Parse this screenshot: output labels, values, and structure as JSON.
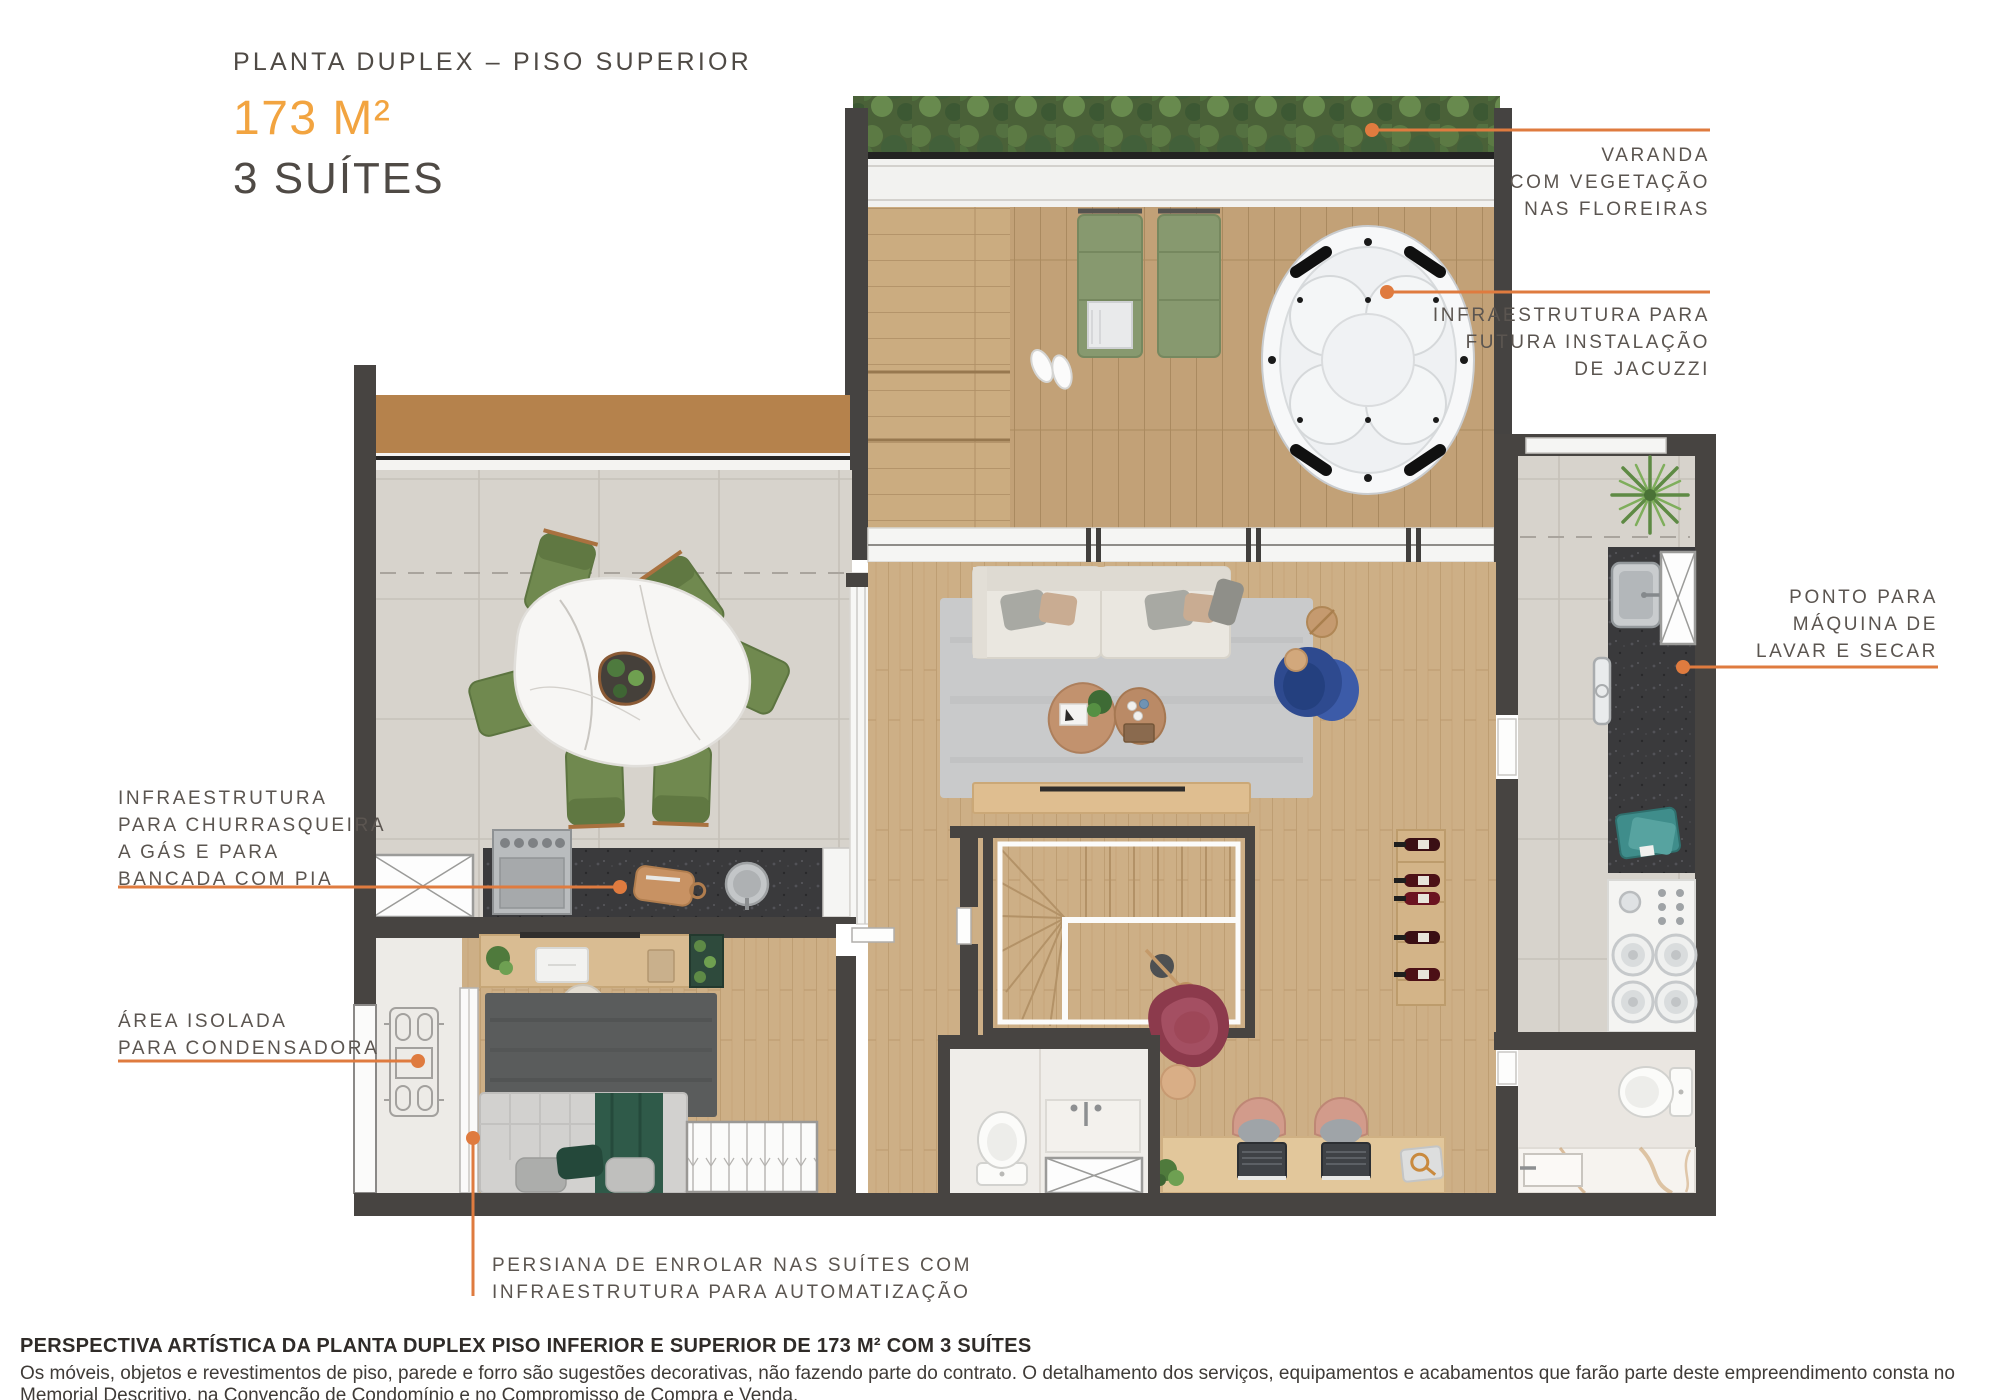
{
  "title": {
    "kicker": "PLANTA DUPLEX – PISO SUPERIOR",
    "area": "173 M²",
    "suites": "3 SUÍTES"
  },
  "annotations": {
    "varanda": {
      "lines": [
        "VARANDA",
        "COM VEGETAÇÃO",
        "NAS FLOREIRAS"
      ]
    },
    "jacuzzi": {
      "lines": [
        "INFRAESTRUTURA PARA",
        "FUTURA INSTALAÇÃO",
        "DE JACUZZI"
      ]
    },
    "lavanderia": {
      "lines": [
        "PONTO PARA",
        "MÁQUINA DE",
        "LAVAR E SECAR"
      ]
    },
    "churrasqueira": {
      "lines": [
        "INFRAESTRUTURA",
        "PARA CHURRASQUEIRA",
        "A GÁS E PARA",
        "BANCADA COM PIA"
      ]
    },
    "condensadora": {
      "lines": [
        "ÁREA ISOLADA",
        "PARA CONDENSADORA"
      ]
    },
    "persiana": {
      "lines": [
        "PERSIANA DE ENROLAR NAS SUÍTES COM",
        "INFRAESTRUTURA PARA AUTOMATIZAÇÃO"
      ]
    }
  },
  "footer": {
    "title": "PERSPECTIVA ARTÍSTICA DA PLANTA DUPLEX PISO INFERIOR E SUPERIOR DE 173 M² COM 3 SUÍTES",
    "disclaimer": "Os móveis, objetos e revestimentos de piso, parede e forro são sugestões decorativas, não fazendo parte do contrato. O detalhamento dos serviços, equipamentos e acabamentos que farão parte deste empreendimento consta no Memorial Descritivo, na Convenção de Condomínio e no Compromisso de Compra e Venda."
  },
  "colors": {
    "accent_orange": "#df7b3f",
    "area_gold": "#f2a440",
    "wall": "#474441",
    "interior_wood": "#cdaf86",
    "deck_wood": "#c2a177",
    "tile": "#d6d2cb",
    "hedge_green": "#4c6439",
    "lounger_green": "#87996f",
    "dining_chair_green": "#70894f",
    "rug_gray": "#c9cacb",
    "suite_rug": "#5a5c5c",
    "granite_dark": "#3a3a3c",
    "teal": "#3f8d8b",
    "sofa_cream": "#eae7e0",
    "armchair_blue": "#2e4a8f",
    "armchair_red": "#8c3a4c",
    "bed_green": "#2f5a49",
    "marble": "#f6f3ef",
    "planter_brown": "#b5824c"
  }
}
